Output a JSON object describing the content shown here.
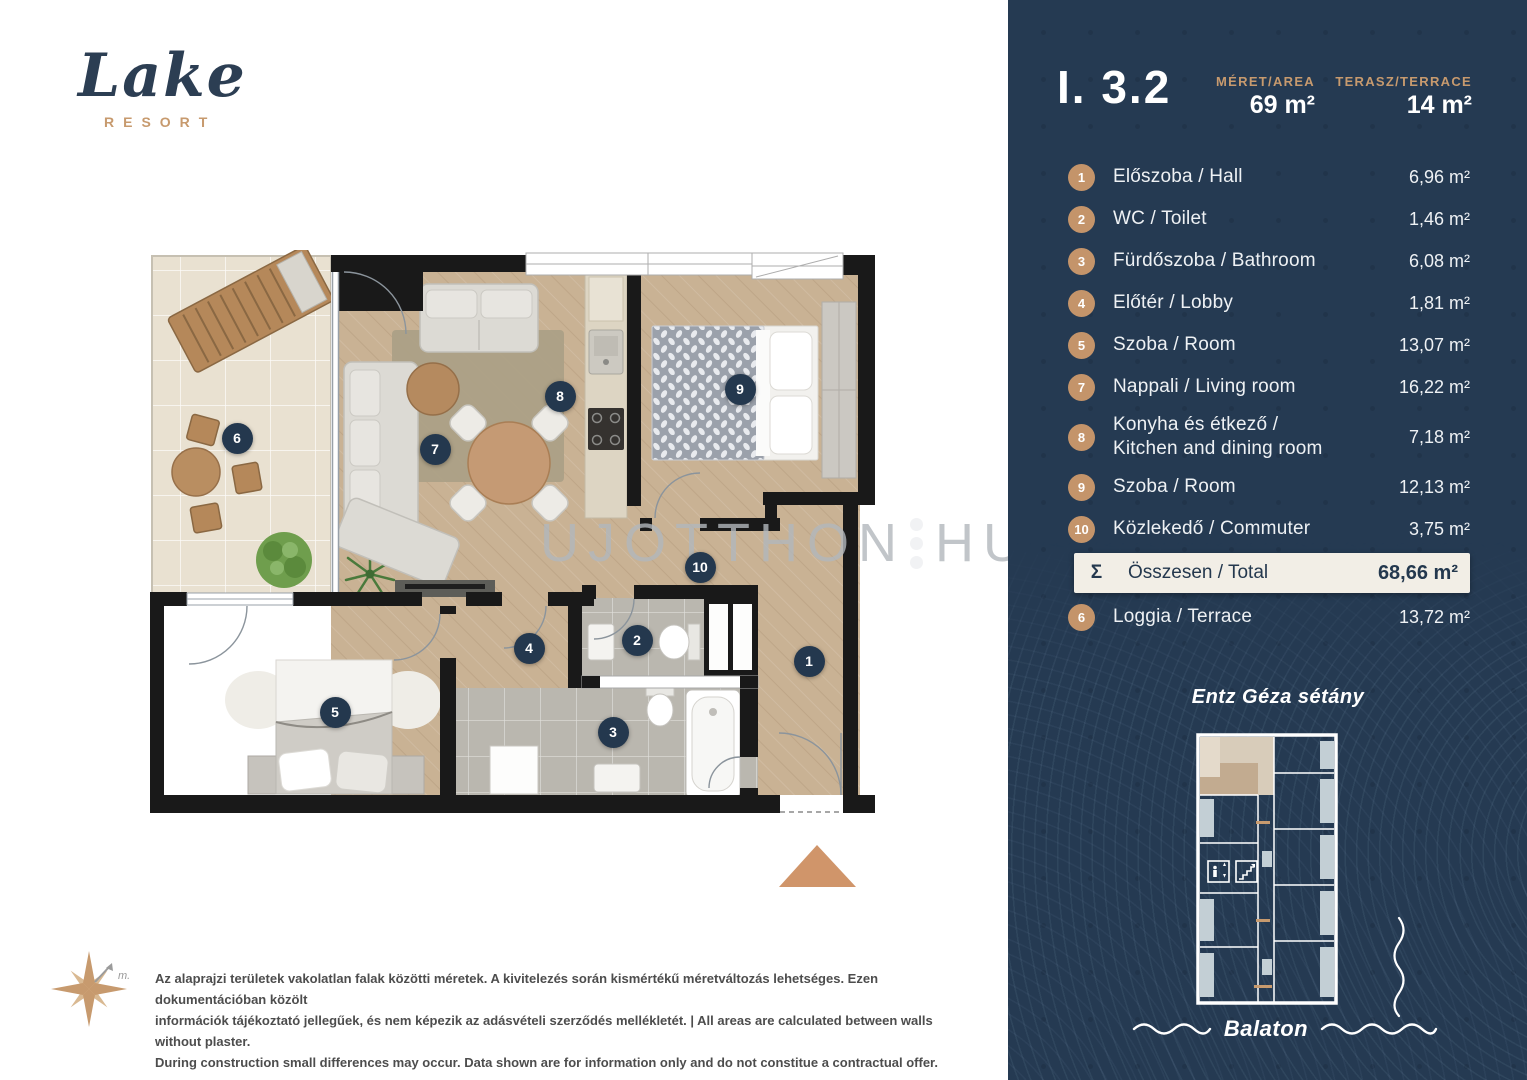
{
  "logo": {
    "name": "Lake",
    "subtitle": "RESORT"
  },
  "unit": {
    "id": "I. 3.2",
    "area_label": "MÉRET/AREA",
    "area_value": "69 m²",
    "terrace_label": "TERASZ/TERRACE",
    "terrace_value": "14 m²"
  },
  "rooms": [
    {
      "num": "1",
      "label": "Előszoba / Hall",
      "area": "6,96  m²"
    },
    {
      "num": "2",
      "label": "WC / Toilet",
      "area": "1,46  m²"
    },
    {
      "num": "3",
      "label": "Fürdőszoba / Bathroom",
      "area": "6,08  m²"
    },
    {
      "num": "4",
      "label": "Előtér / Lobby",
      "area": "1,81  m²"
    },
    {
      "num": "5",
      "label": "Szoba / Room",
      "area": "13,07  m²"
    },
    {
      "num": "7",
      "label": "Nappali / Living room",
      "area": "16,22  m²"
    },
    {
      "num": "8",
      "label": "Konyha  és étkező /",
      "label2": "Kitchen and dining room",
      "area": "7,18  m²"
    },
    {
      "num": "9",
      "label": "Szoba / Room",
      "area": "12,13  m²"
    },
    {
      "num": "10",
      "label": "Közlekedő / Commuter",
      "area": "3,75  m²"
    }
  ],
  "total": {
    "symbol": "Σ",
    "label": "Összesen / Total",
    "area": "68,66 m²"
  },
  "loggia": {
    "num": "6",
    "label": "Loggia / Terrace",
    "area": "13,72  m²"
  },
  "map": {
    "street": "Entz Géza sétány",
    "lake": "Balaton"
  },
  "plan": {
    "watermark_left": "UJOTTHON",
    "watermark_right": "HU",
    "markers": [
      {
        "n": "1",
        "x": 809,
        "y": 661
      },
      {
        "n": "2",
        "x": 637,
        "y": 640
      },
      {
        "n": "3",
        "x": 613,
        "y": 732
      },
      {
        "n": "4",
        "x": 529,
        "y": 648
      },
      {
        "n": "5",
        "x": 335,
        "y": 712
      },
      {
        "n": "6",
        "x": 237,
        "y": 438
      },
      {
        "n": "7",
        "x": 435,
        "y": 449
      },
      {
        "n": "8",
        "x": 560,
        "y": 396
      },
      {
        "n": "9",
        "x": 740,
        "y": 389
      },
      {
        "n": "10",
        "x": 700,
        "y": 567
      }
    ]
  },
  "disclaimer": {
    "lines": [
      "Az alaprajzi területek vakolatlan falak közötti méretek. A kivitelezés során kismértékű méretváltozás lehetséges. Ezen dokumentációban közölt",
      "információk tájékoztató jellegűek, és nem képezik az adásvételi szerződés mellékletét. | All areas are calculated between walls without plaster.",
      "During construction small differences may occur. Data shown are for information only and do not constitue a contractual offer."
    ]
  },
  "misc": {
    "compass_mark": "m."
  },
  "icons": {
    "compass": "compass-rose-icon",
    "elevator": "elevator-icon",
    "stairs": "stairs-icon",
    "entrance_arrow": "entrance-arrow-icon"
  },
  "colors": {
    "panel_navy": "#253A52",
    "accent_gold": "#C79A6E",
    "total_cream": "#F2EEE6",
    "marker_navy": "#24384E",
    "wall_black": "#191919",
    "wood_floor": "#C9B294",
    "terrace_tile": "#E9E1D1",
    "bath_tile": "#BAB7AF",
    "entrance_arrow": "#D0956A"
  }
}
